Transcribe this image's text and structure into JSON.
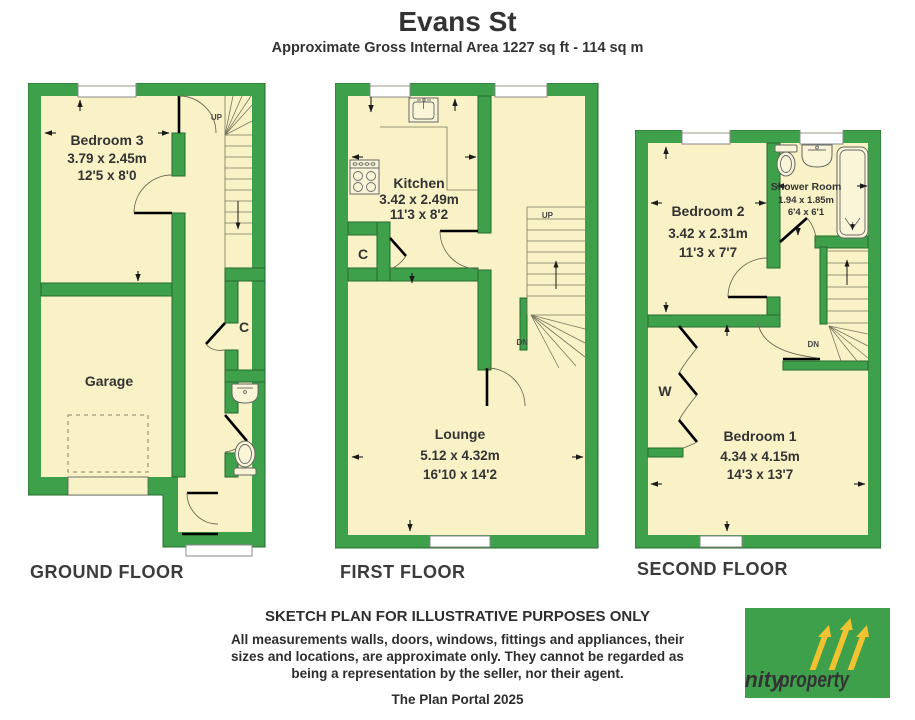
{
  "header": {
    "title": "Evans St",
    "subtitle": "Approximate Gross Internal Area 1227 sq ft - 114 sq m"
  },
  "ground": {
    "label": "GROUND FLOOR",
    "bedroom3": {
      "name": "Bedroom 3",
      "metric": "3.79 x 2.45m",
      "imperial": "12'5 x 8'0"
    },
    "garage": {
      "name": "Garage"
    },
    "cupboard": "C",
    "stairs_up": "UP"
  },
  "first": {
    "label": "FIRST FLOOR",
    "kitchen": {
      "name": "Kitchen",
      "metric": "3.42 x 2.49m",
      "imperial": "11'3 x 8'2"
    },
    "lounge": {
      "name": "Lounge",
      "metric": "5.12 x 4.32m",
      "imperial": "16'10 x 14'2"
    },
    "cupboard": "C",
    "stairs_up": "UP",
    "stairs_down": "DN"
  },
  "second": {
    "label": "SECOND FLOOR",
    "bedroom2": {
      "name": "Bedroom 2",
      "metric": "3.42 x 2.31m",
      "imperial": "11'3 x 7'7"
    },
    "shower": {
      "name": "Shower Room",
      "metric": "1.94 x 1.85m",
      "imperial": "6'4 x 6'1"
    },
    "bedroom1": {
      "name": "Bedroom 1",
      "metric": "4.34 x 4.15m",
      "imperial": "14'3 x 13'7"
    },
    "wardrobe": "W",
    "stairs_down": "DN"
  },
  "footer": {
    "disclaimer_title": "SKETCH PLAN FOR ILLUSTRATIVE PURPOSES ONLY",
    "disclaimer_line1": "All measurements walls, doors, windows, fittings and appliances, their",
    "disclaimer_line2": "sizes and locations, are approximate only. They cannot be regarded as",
    "disclaimer_line3": "being a representation by the seller, nor their agent.",
    "credit": "The Plan Portal 2025"
  },
  "logo": {
    "brand_primary": "trinity",
    "brand_secondary": "property",
    "background": "#3EA04B",
    "arrow_color": "#F2C230"
  },
  "colors": {
    "wall_green": "#3EA04B",
    "wall_outline": "#246B2C",
    "room_fill": "#F9F2C6",
    "text": "#333333"
  }
}
